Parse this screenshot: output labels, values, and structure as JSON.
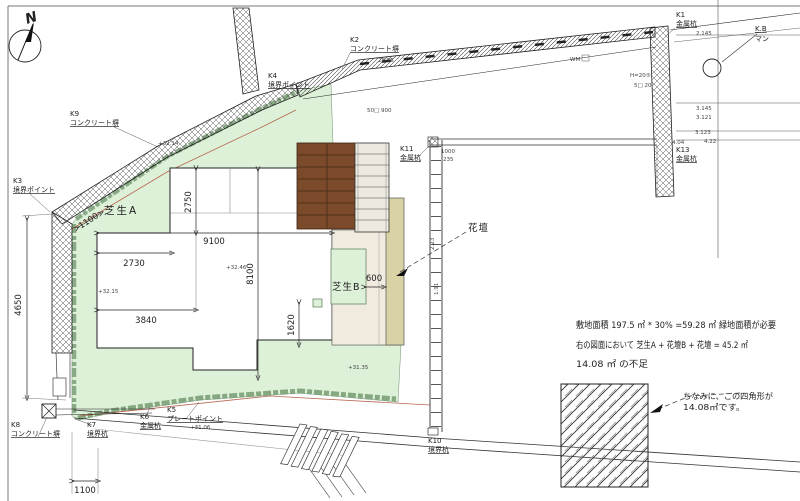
{
  "drawing": {
    "north_label": "N",
    "areas": {
      "lawn_a": "芝生A",
      "lawn_b": "芝生B",
      "flowerbed": "花壇"
    },
    "notes": {
      "line1": "敷地面積 197.5 ㎡ * 30% =59.28 ㎡ 緑地面積が必要",
      "line2": "右の図面において 芝生A + 花壇B + 花壇 = 45.2 ㎡",
      "line3": "14.08 ㎡ の不足"
    },
    "callout": {
      "line1": "ちなみに、この四角形が",
      "line2": "14.08㎡です。"
    },
    "dims": {
      "d2750": "2750",
      "d9100": "9100",
      "d2730": "2730",
      "d3840": "3840",
      "d8100": "8100",
      "d4650": "4650",
      "d1100_diag": "1100",
      "d1100_bottom": "1100",
      "d1620": "1620",
      "d600": "600"
    },
    "markers": [
      {
        "code": "K9",
        "name": "コンクリート塀"
      },
      {
        "code": "K2",
        "name": "コンクリート塀"
      },
      {
        "code": "K4",
        "name": "境界ポイント"
      },
      {
        "code": "K3",
        "name": "境界ポイント"
      },
      {
        "code": "K1",
        "name": "金属杭"
      },
      {
        "code": "K13",
        "name": "金属杭"
      },
      {
        "code": "K11",
        "name": "金属杭"
      },
      {
        "code": "K8",
        "name": "コンクリート塀"
      },
      {
        "code": "K7",
        "name": "境界杭"
      },
      {
        "code": "K6",
        "name": "金属杭"
      },
      {
        "code": "K5",
        "name": "プレートポイント"
      },
      {
        "code": "K10",
        "name": "境界杭"
      },
      {
        "code": "K.B",
        "name": "マン"
      }
    ],
    "annotations": [
      "WM",
      "50□ 900",
      "H=20⑤",
      "5□ 20",
      "28.55",
      "2.145",
      "3.145",
      "3.121",
      "3.123",
      "4.22",
      "4.04",
      "+32.14",
      "+32.15",
      "+32.46",
      "+31.35",
      "+31.06",
      "1000",
      "235",
      "2.23",
      "1.91"
    ],
    "colors": {
      "lawn": "#ddf0d8",
      "lawn_edge": "#7fa37c",
      "deck": "#7a4a2a",
      "approach": "#f1ebdf",
      "bed": "#d9d2a4",
      "stair": "#eee9df"
    }
  }
}
